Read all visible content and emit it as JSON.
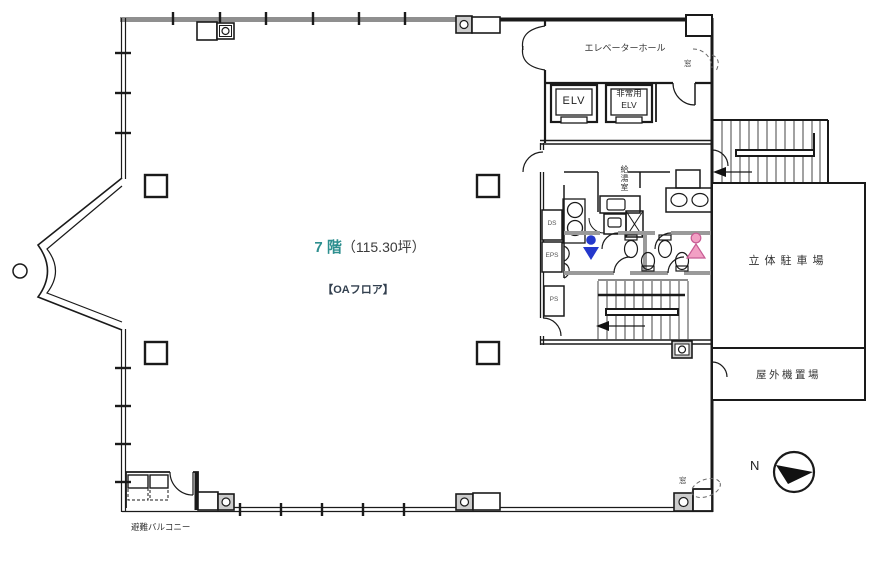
{
  "title": {
    "floor": "7 階",
    "area": "（115.30坪）",
    "type_note": "【OAフロア】"
  },
  "rooms": {
    "elevator_hall": "エレベーターホール",
    "elv": "ELV",
    "emergency_elv_line1": "非常用",
    "emergency_elv_line2": "ELV",
    "kitchenette": "給湯室",
    "parking": "立体駐車場",
    "outdoor_equipment": "屋外機置場",
    "evacuation_balcony": "避難バルコニー"
  },
  "shafts": {
    "ds": "DS",
    "eps": "EPS",
    "ps": "PS"
  },
  "annotations": {
    "window_upper": "窓",
    "window_lower": "窓",
    "north": "N"
  },
  "colors": {
    "accent": "#2E8F8F",
    "wall": "#1A1A1A",
    "window_wall": "#8F8F8F",
    "partition": "#9A9A9A",
    "shaded_fixture": "#CCCCCC",
    "male": "#2438CC",
    "female_fill": "#F2A0C4",
    "female_stroke": "#C75B93"
  }
}
